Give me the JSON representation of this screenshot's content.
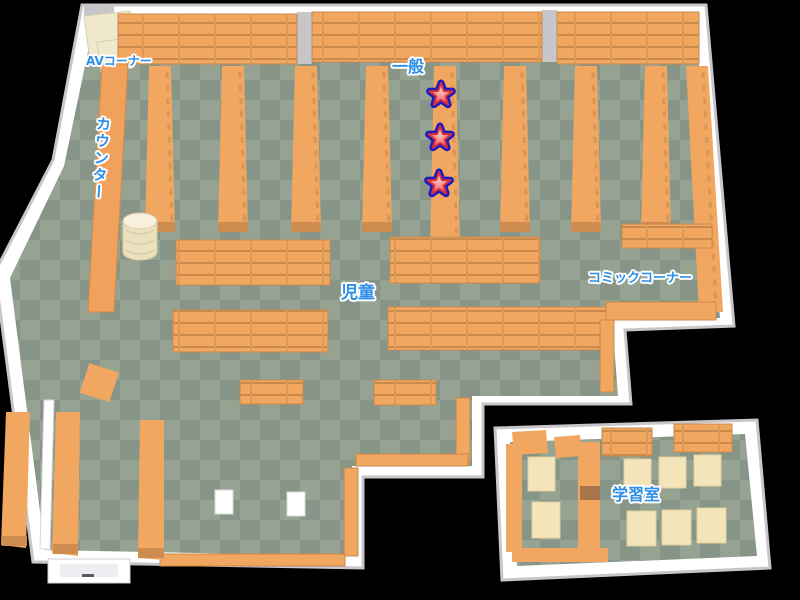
{
  "map": {
    "kind": "library-floor-map",
    "areas": {
      "av_corner": {
        "label": "AVコーナー"
      },
      "counter": {
        "label": "カウンター"
      },
      "general": {
        "label": "一般"
      },
      "children": {
        "label": "児童"
      },
      "comic_corner": {
        "label": "コミックコーナー"
      },
      "study_room": {
        "label": "学習室"
      }
    },
    "markers": [
      {
        "icon": "star-icon",
        "x": 441,
        "y": 95
      },
      {
        "icon": "star-icon",
        "x": 440,
        "y": 138
      },
      {
        "icon": "star-icon",
        "x": 439,
        "y": 184
      }
    ],
    "colors": {
      "background": "#000000",
      "floor_light": "#96a292",
      "floor_dark": "#879588",
      "wall": "#ffffff",
      "wall_shade": "#c6c6cb",
      "shelf_orange": "#f1a75f",
      "shelf_line": "#c98a4e",
      "desk_cream": "#f3e4ba",
      "label_blue": "#2e8fe8",
      "star_outline_blue": "#1c1cbe",
      "star_red": "#e23c3c"
    }
  }
}
